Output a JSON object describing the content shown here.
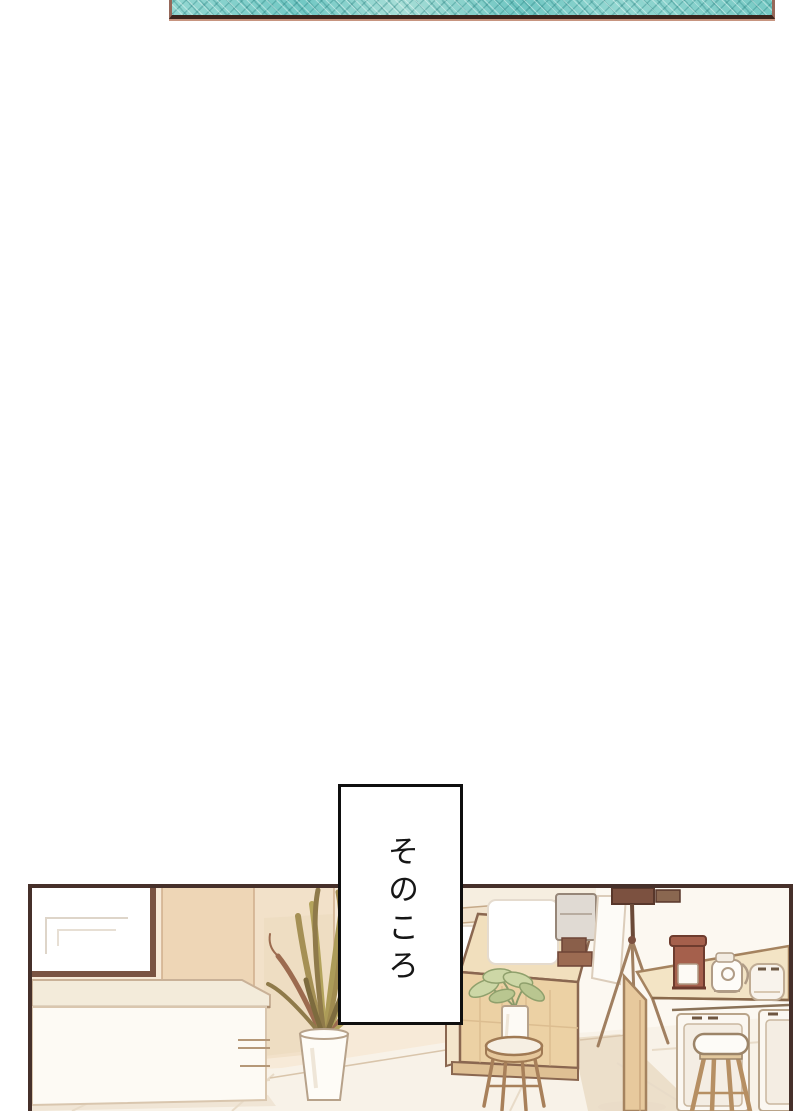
{
  "meta": {
    "type": "manga-page",
    "language": "ja",
    "background": "#ffffff"
  },
  "caption": {
    "text": "そのころ",
    "writing_mode": "vertical"
  },
  "panels": {
    "top": {
      "description": "narrow sliver of the previous panel showing teal water-like crosshatch pattern",
      "fill": "#7bcdc8",
      "hatch": "#2a7878",
      "border_side": "#96685a",
      "border_bottom": "#3a241c"
    },
    "bottom": {
      "description": "cafe interior: framed whiteboard, white counter, tall potted plant, wooden coffee counter with menu sign and espresso machine, small plant on stool, camera tripod, wooden table with coffee maker, kettle and toaster, mini-fridge doors, bar stool",
      "border": "#46302a"
    }
  },
  "scene": {
    "objects": [
      "wall",
      "wall-panel-strip",
      "floor",
      "whiteboard-frame",
      "white-counter",
      "tall-potted-plant",
      "plant-vase",
      "wooden-counter",
      "menu-sign",
      "espresso-machine",
      "small-plant",
      "plant-stool",
      "camera-tripod",
      "hanging-cloth",
      "back-shelf",
      "wooden-table",
      "coffee-maker",
      "electric-kettle",
      "toaster",
      "fridge-door-left",
      "fridge-door-right",
      "bar-stool"
    ]
  },
  "colors": {
    "teal": "#7bcdc8",
    "caption_border": "#0f0f0f",
    "panel_border": "#46302a",
    "wall": "#f7ead8",
    "wall_strip": "#eed6b6",
    "floor": "#f8f2e8",
    "shadow": "#ecdfca",
    "wood": "#ecd1a4",
    "wood_top": "#f1dfbd",
    "wood_outline": "#8a6750",
    "white_surface": "#fdfaf4",
    "leaf_olive": "#aa9a55",
    "leaf_brown": "#9c6b4f",
    "leaf_green": "#cdd7a6",
    "appliance_brown": "#a5604c"
  }
}
